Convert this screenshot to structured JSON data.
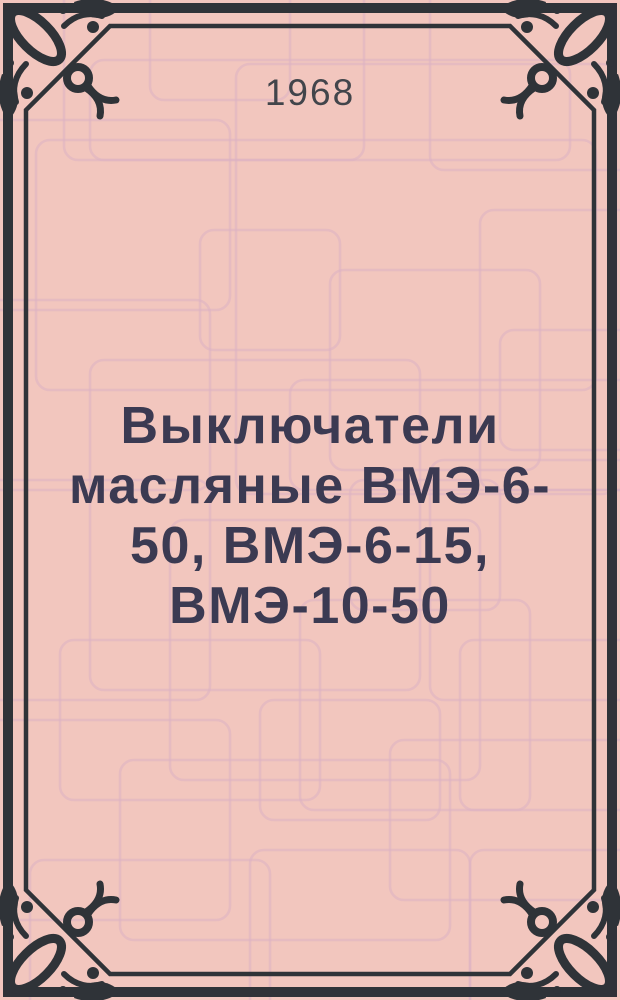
{
  "cover": {
    "year": "1968",
    "title": "Выключатели масляные ВМЭ-6-50, ВМЭ-6-15, ВМЭ-10-50",
    "title_lines": [
      "Выключатели",
      "масляные ВМЭ-6-",
      "50, ВМЭ-6-15,",
      "ВМЭ-10-50"
    ]
  },
  "theme": {
    "background_color": "#f2c6be",
    "pattern_line_color": "#dcb3c2",
    "frame_color": "#2f3338",
    "year_color": "#42454b",
    "title_color": "#3b3a52"
  }
}
